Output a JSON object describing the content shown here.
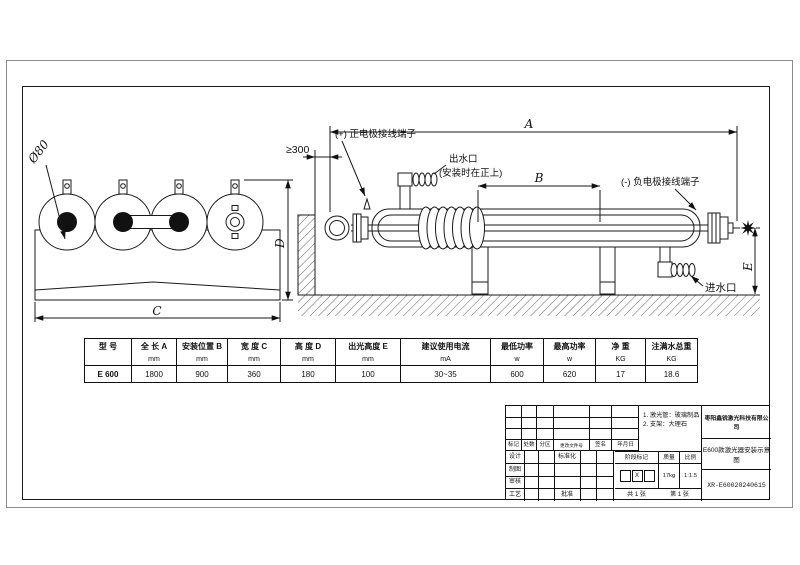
{
  "drawing": {
    "labels": {
      "dia80": "Ø80",
      "dim_a": "A",
      "dim_b": "B",
      "dim_c": "C",
      "dim_d": "D",
      "dim_e": "E",
      "min300": "≥300",
      "pos_electrode": "(+) 正电极接线端子",
      "neg_electrode": "(-) 负电极接线端子",
      "outlet": "出水口",
      "outlet_note": "(安装时在正上)",
      "inlet": "进水口"
    }
  },
  "spec_table": {
    "columns": [
      {
        "name": "型  号",
        "unit": ""
      },
      {
        "name": "全 长 A",
        "unit": "mm"
      },
      {
        "name": "安装位置 B",
        "unit": "mm"
      },
      {
        "name": "宽 度 C",
        "unit": "mm"
      },
      {
        "name": "高 度 D",
        "unit": "mm"
      },
      {
        "name": "出光高度 E",
        "unit": "mm"
      },
      {
        "name": "建议使用电流",
        "unit": "mA"
      },
      {
        "name": "最低功率",
        "unit": "w"
      },
      {
        "name": "最高功率",
        "unit": "w"
      },
      {
        "name": "净  重",
        "unit": "KG"
      },
      {
        "name": "注满水总重",
        "unit": "KG"
      }
    ],
    "row": [
      "E 600",
      "1800",
      "900",
      "360",
      "180",
      "100",
      "30~35",
      "600",
      "620",
      "17",
      "18.6"
    ]
  },
  "title_block": {
    "notes": {
      "line1": "1. 激光管：玻璃制品",
      "line2": "2. 支架：大理石"
    },
    "revision_header": [
      "标记",
      "处数",
      "分区",
      "更改文件号",
      "签名",
      "年月日"
    ],
    "sign_rows": {
      "design": "设计",
      "draft": "制图",
      "check": "审核",
      "process": "工艺",
      "standardize": "标准化",
      "approve": "批准"
    },
    "stage_mark_label": "阶段标记",
    "stage_mark_value": "X",
    "weight_label": "质量",
    "weight_value": "17kg",
    "scale_label": "比例",
    "scale_value": "1:1.5",
    "sheet_total": "共 1 张",
    "sheet_page": "第 1 张",
    "company": "枣阳鑫锐激光科技有限公司",
    "title": "E600款激光器安装示意图",
    "drawing_no": "XR-E60020240615"
  }
}
